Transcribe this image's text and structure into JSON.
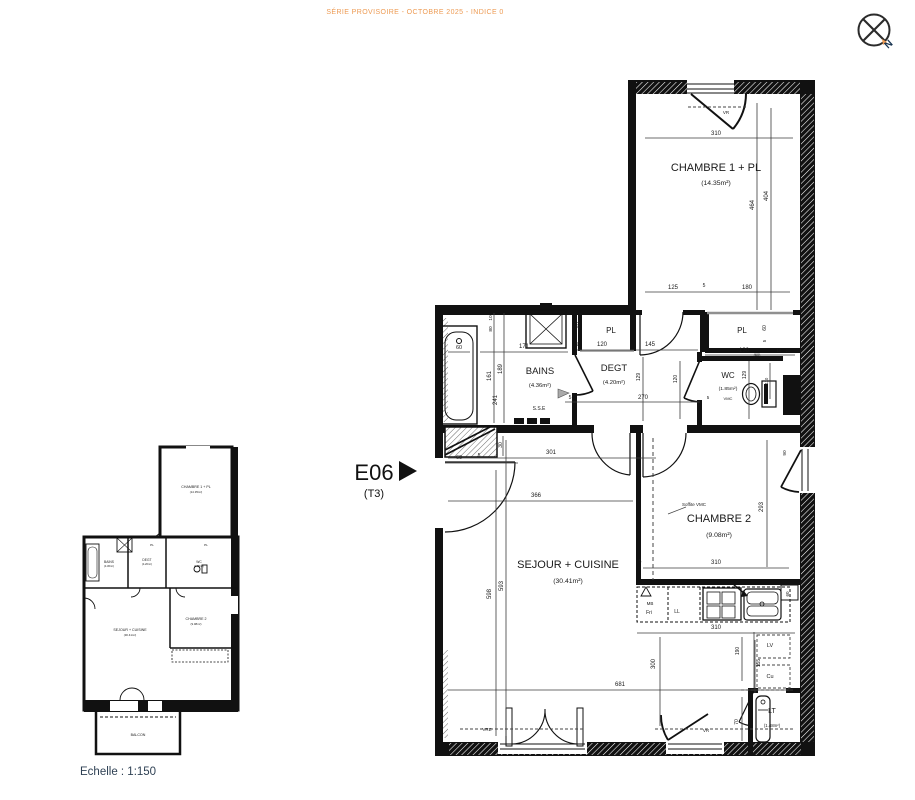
{
  "header": {
    "title": "SÉRIE PROVISOIRE - OCTOBRE 2025 - INDICE 0"
  },
  "compass": {
    "label": "N"
  },
  "unit": {
    "code": "E06",
    "type": "(T3)"
  },
  "scale": {
    "label": "Echelle : 1:150"
  },
  "colors": {
    "accent": "#ED9B54",
    "ink": "#1a1a1a",
    "muted": "#3c3c3c",
    "scale_text": "#2F4154"
  },
  "main_plan": {
    "rooms": [
      {
        "n": "CHAMBRE 1 + PL",
        "a": "(14.35m²)",
        "x": 716,
        "y": 171,
        "ay": 185,
        "fs": 11
      },
      {
        "n": "BAINS",
        "a": "(4.36m²)",
        "x": 540,
        "y": 374,
        "ay": 387,
        "fs": 9.5
      },
      {
        "n": "DEGT",
        "a": "(4.20m²)",
        "x": 614,
        "y": 371,
        "ay": 384,
        "fs": 9.5
      },
      {
        "n": "WC",
        "a": "(1.85m²)",
        "x": 728,
        "y": 378,
        "ay": 390,
        "fs": 8
      },
      {
        "n": "PL",
        "x": 611,
        "y": 333,
        "fs": 8
      },
      {
        "n": "PL",
        "x": 742,
        "y": 333,
        "fs": 8
      },
      {
        "n": "SEJOUR + CUISINE",
        "a": "(30.41m²)",
        "x": 568,
        "y": 568,
        "ay": 583,
        "fs": 11
      },
      {
        "n": "CHAMBRE 2",
        "a": "(9.08m²)",
        "x": 719,
        "y": 522,
        "ay": 537,
        "fs": 11
      },
      {
        "n": "LT",
        "a": "(1.48m²)",
        "x": 772,
        "y": 713,
        "ay": 727,
        "fs": 7
      }
    ],
    "dimensions": [
      {
        "v": "310",
        "x": 716,
        "y": 135
      },
      {
        "v": "125",
        "x": 673,
        "y": 289
      },
      {
        "v": "5",
        "x": 704,
        "y": 287,
        "fs": 5
      },
      {
        "v": "180",
        "x": 747,
        "y": 289
      },
      {
        "v": "464",
        "x": 754,
        "y": 205,
        "r": 1
      },
      {
        "v": "404",
        "x": 768,
        "y": 196,
        "r": 1
      },
      {
        "v": "VR",
        "x": 726,
        "y": 114,
        "fs": 4.5
      },
      {
        "v": "60",
        "x": 580,
        "y": 325,
        "r": 1,
        "fs": 5
      },
      {
        "v": "60",
        "x": 766,
        "y": 328,
        "r": 1,
        "fs": 5
      },
      {
        "v": "5",
        "x": 766,
        "y": 341,
        "r": 1,
        "fs": 4.5
      },
      {
        "v": "171",
        "x": 524,
        "y": 348
      },
      {
        "v": "5",
        "x": 577,
        "y": 346,
        "fs": 5
      },
      {
        "v": "120",
        "x": 602,
        "y": 346
      },
      {
        "v": "145",
        "x": 650,
        "y": 346
      },
      {
        "v": "130",
        "x": 744,
        "y": 352
      },
      {
        "v": "(60)",
        "x": 757,
        "y": 356,
        "fs": 3.8
      },
      {
        "v": "10",
        "x": 779,
        "y": 352,
        "fs": 4.2
      },
      {
        "v": "20",
        "x": 788,
        "y": 352,
        "fs": 4.2
      },
      {
        "v": "10",
        "x": 492,
        "y": 318,
        "r": 1,
        "fs": 4.8
      },
      {
        "v": "80",
        "x": 492,
        "y": 329,
        "r": 1,
        "fs": 4.8
      },
      {
        "v": "60",
        "x": 459,
        "y": 349,
        "fs": 5.5
      },
      {
        "v": "161",
        "x": 491,
        "y": 376,
        "r": 1
      },
      {
        "v": "189",
        "x": 502,
        "y": 369,
        "r": 1
      },
      {
        "v": "241",
        "x": 497,
        "y": 400,
        "r": 1
      },
      {
        "v": "129",
        "x": 640,
        "y": 377,
        "r": 1,
        "fs": 5
      },
      {
        "v": "270",
        "x": 643,
        "y": 399
      },
      {
        "v": "5",
        "x": 570,
        "y": 399,
        "fs": 5
      },
      {
        "v": "120",
        "x": 677,
        "y": 379,
        "r": 1,
        "fs": 5
      },
      {
        "v": "129",
        "x": 746,
        "y": 375,
        "r": 1,
        "fs": 5
      },
      {
        "v": "110",
        "x": 768,
        "y": 381,
        "r": 1,
        "fs": 4.2
      },
      {
        "v": "5",
        "x": 708,
        "y": 399,
        "fs": 4.5
      },
      {
        "v": "30",
        "x": 502,
        "y": 445,
        "r": 1,
        "fs": 5
      },
      {
        "v": "60",
        "x": 459,
        "y": 459,
        "fs": 5.5
      },
      {
        "v": "5",
        "x": 479,
        "y": 457,
        "fs": 5
      },
      {
        "v": "301",
        "x": 551,
        "y": 454
      },
      {
        "v": "366",
        "x": 536,
        "y": 497
      },
      {
        "v": "598",
        "x": 491,
        "y": 594,
        "r": 1
      },
      {
        "v": "593",
        "x": 503,
        "y": 586,
        "r": 1
      },
      {
        "v": "5",
        "x": 640,
        "y": 563,
        "fs": 5
      },
      {
        "v": "310",
        "x": 716,
        "y": 564
      },
      {
        "v": "293",
        "x": 763,
        "y": 507,
        "r": 1
      },
      {
        "v": "90",
        "x": 786,
        "y": 453,
        "r": 1,
        "fs": 4.8
      },
      {
        "v": "310",
        "x": 716,
        "y": 629
      },
      {
        "v": "190",
        "x": 739,
        "y": 651,
        "r": 1,
        "fs": 5
      },
      {
        "v": "155",
        "x": 760,
        "y": 663,
        "r": 1,
        "fs": 5
      },
      {
        "v": "300",
        "x": 655,
        "y": 664,
        "r": 1
      },
      {
        "v": "70",
        "x": 738,
        "y": 722,
        "r": 1,
        "fs": 5
      },
      {
        "v": "681",
        "x": 620,
        "y": 686
      },
      {
        "v": "60",
        "x": 789,
        "y": 594,
        "r": 1,
        "fs": 4.5
      }
    ],
    "annotations": [
      {
        "t": "VRE",
        "x": 487,
        "y": 731,
        "fs": 4.5
      },
      {
        "t": "VR",
        "x": 706,
        "y": 732,
        "fs": 4.5
      },
      {
        "t": "S.S.E",
        "x": 539,
        "y": 410,
        "fs": 5
      },
      {
        "t": "VMC",
        "x": 728,
        "y": 400,
        "fs": 4
      },
      {
        "t": "Soffite VMC",
        "x": 694,
        "y": 506,
        "fs": 4.5
      },
      {
        "t": "MB",
        "x": 650,
        "y": 605,
        "fs": 4.5
      },
      {
        "t": "Fri",
        "x": 649,
        "y": 614,
        "fs": 5
      },
      {
        "t": "LL",
        "x": 677,
        "y": 613,
        "fs": 5
      },
      {
        "t": "LV",
        "x": 770,
        "y": 647,
        "fs": 5.5
      },
      {
        "t": "Cu",
        "x": 770,
        "y": 678,
        "fs": 5.5
      }
    ]
  },
  "overview_plan": {
    "labels": [
      {
        "t": "CHAMBRE 1 + PL",
        "x": 196,
        "y": 488,
        "fs": 3.6
      },
      {
        "t": "(14.35m²)",
        "x": 196,
        "y": 493,
        "fs": 2.9
      },
      {
        "t": "BAINS",
        "x": 109,
        "y": 563,
        "fs": 3.3
      },
      {
        "t": "(4.36m²)",
        "x": 109,
        "y": 567,
        "fs": 2.7
      },
      {
        "t": "DEGT",
        "x": 147,
        "y": 561,
        "fs": 3.3
      },
      {
        "t": "(4.20m²)",
        "x": 147,
        "y": 565,
        "fs": 2.7
      },
      {
        "t": "WC",
        "x": 199,
        "y": 563,
        "fs": 3.3
      },
      {
        "t": "(1.85m²)",
        "x": 199,
        "y": 567,
        "fs": 2.7
      },
      {
        "t": "PL",
        "x": 152,
        "y": 546,
        "fs": 3.1
      },
      {
        "t": "PL",
        "x": 206,
        "y": 546,
        "fs": 3.1
      },
      {
        "t": "SEJOUR + CUISINE",
        "x": 130,
        "y": 631,
        "fs": 3.6
      },
      {
        "t": "(30.41m²)",
        "x": 130,
        "y": 636,
        "fs": 2.9
      },
      {
        "t": "CHAMBRE 2",
        "x": 196,
        "y": 620,
        "fs": 3.6
      },
      {
        "t": "(9.08m²)",
        "x": 196,
        "y": 625,
        "fs": 2.9
      },
      {
        "t": "BALCON",
        "x": 138,
        "y": 736,
        "fs": 3.6
      }
    ]
  }
}
